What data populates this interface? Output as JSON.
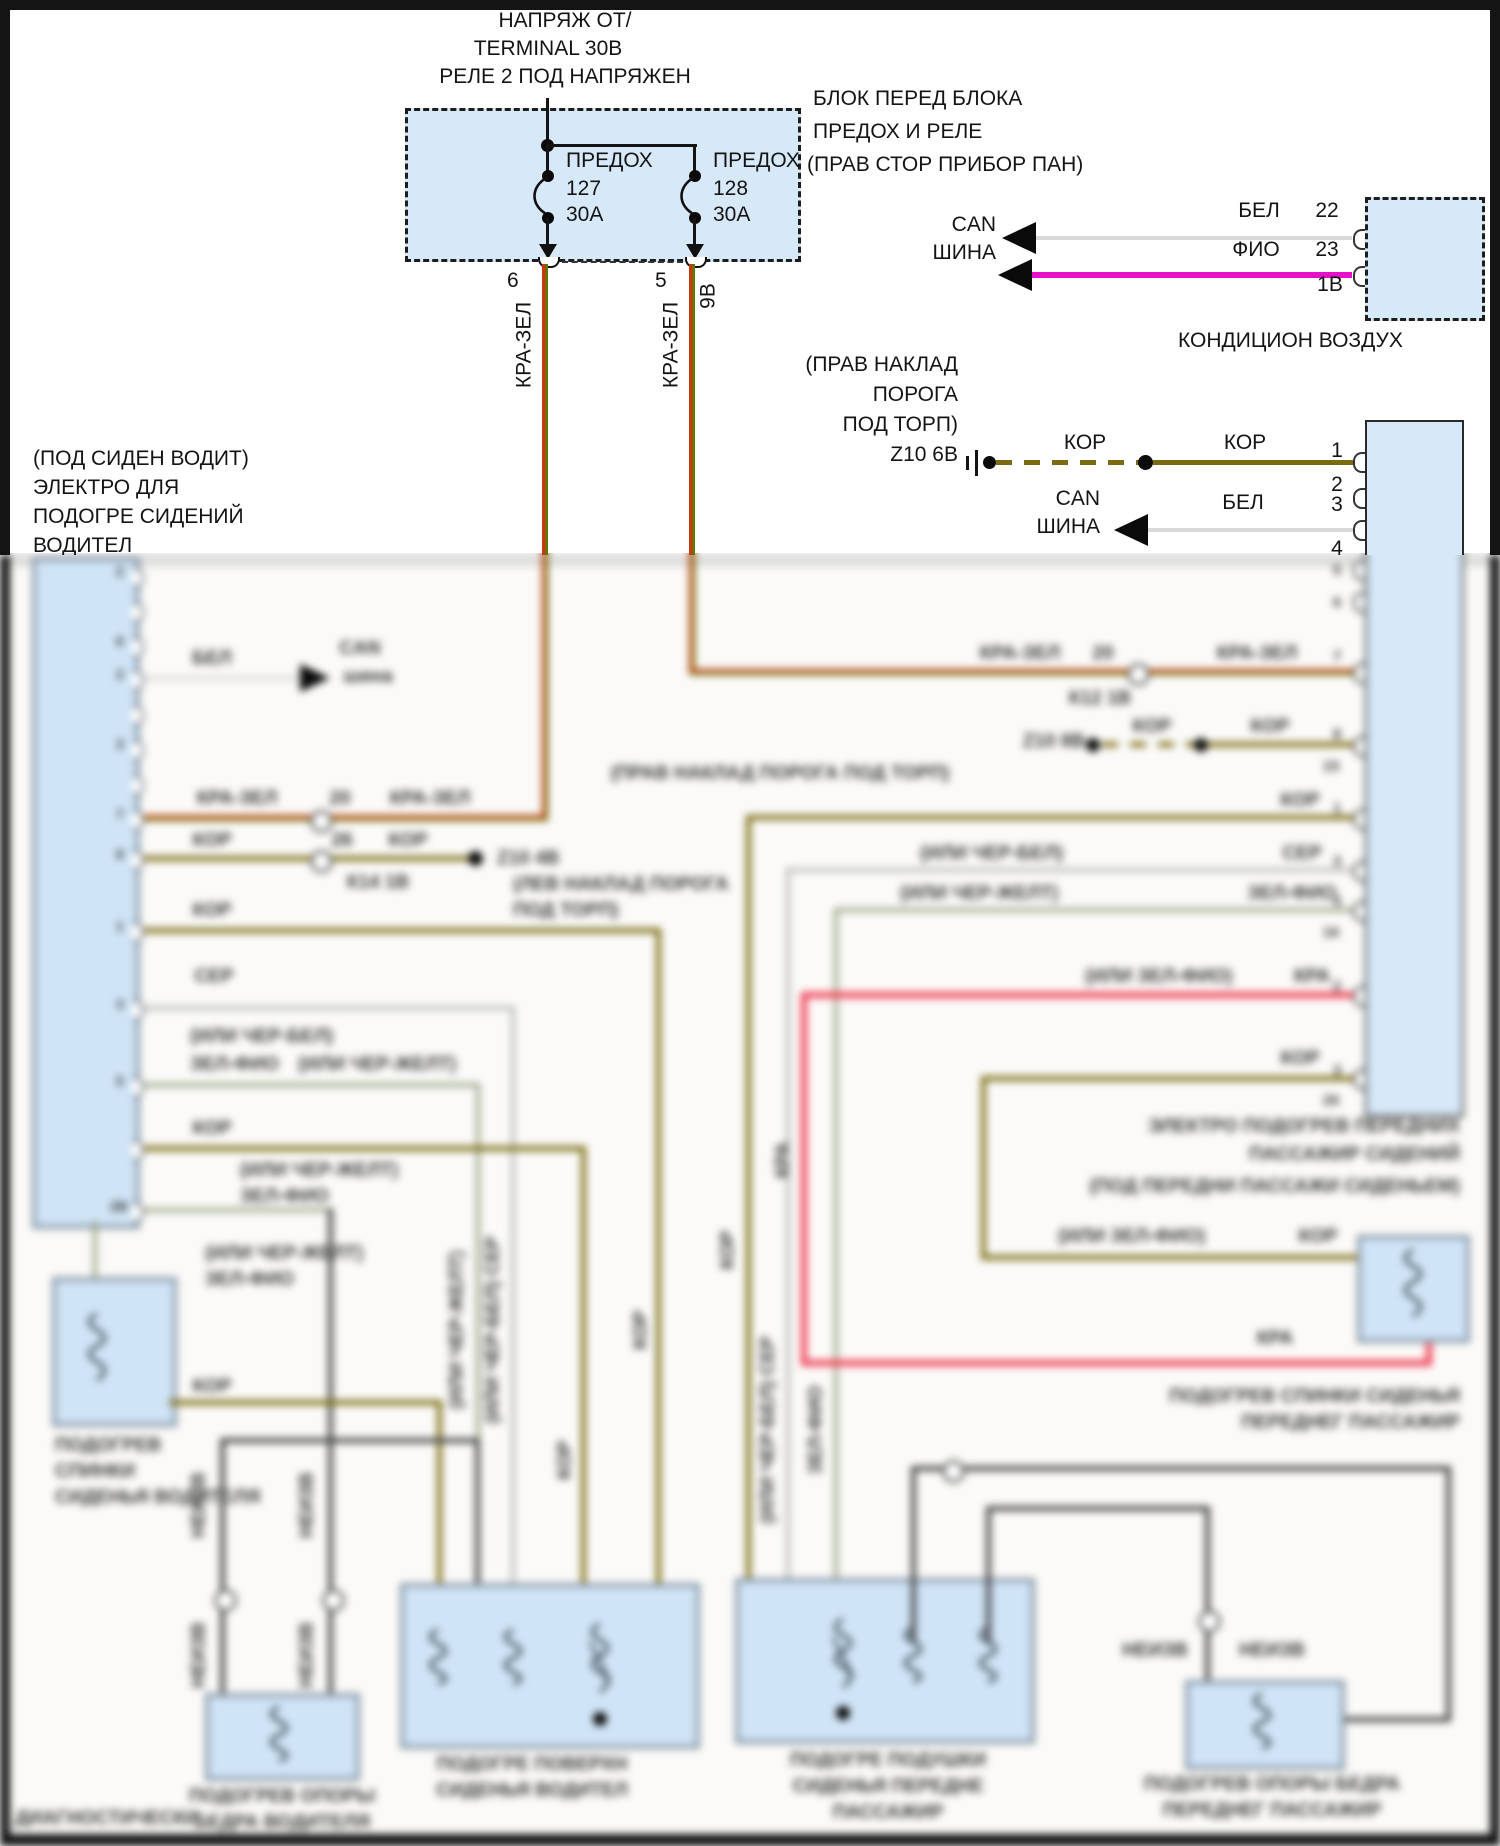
{
  "colors": {
    "box_fill": "#d7e8f8",
    "kra_zel_red": "#c63a10",
    "kra_zel_green": "#5d7a00",
    "kor": "#7a6a10",
    "fio": "#e611c9",
    "bel": "#d8d8d8",
    "ser": "#b9b9b9",
    "zel_fio": "#97a183",
    "kra": "#ef4055",
    "cher": "#474747"
  },
  "top": {
    "feed": [
      "НАПРЯЖ ОТ/",
      "TERMINAL 30В",
      "РЕЛЕ 2 ПОД НАПРЯЖЕН"
    ],
    "block_label": [
      "БЛОК ПЕРЕД БЛОКА",
      "ПРЕДОХ И РЕЛЕ",
      "(ПРАВ СТОР ПРИБОР ПАН)"
    ],
    "fuse1": {
      "t": "ПРЕДОХ",
      "n": "127",
      "a": "30А"
    },
    "fuse2": {
      "t": "ПРЕДОХ",
      "n": "128",
      "a": "30А"
    },
    "pin_left": "6",
    "pin_right": "5",
    "pin_right2": "9В",
    "wire": "КРА-ЗЕЛ"
  },
  "ac": {
    "can": "CAN",
    "bus": "ШИНА",
    "w1": "БЕЛ",
    "p1": "22",
    "w2": "ФИО",
    "p2": "23",
    "p3": "1В",
    "name": "КОНДИЦИОН ВОЗДУХ"
  },
  "sill_right": {
    "l1": "(ПРАВ НАКЛАД",
    "l2": "ПОРОГА",
    "l3": "ПОД ТОРП)",
    "gnd": "Z10 6В",
    "w1": "КОР",
    "w2": "КОР",
    "p1": "1",
    "p2": "2"
  },
  "canr": {
    "can": "CAN",
    "bus": "ШИНА",
    "w": "БЕЛ",
    "p3": "3",
    "p4": "4"
  },
  "driver_module": [
    "(ПОД СИДЕН ВОДИТ)",
    "ЭЛЕКТРО ДЛЯ",
    "ПОДОГРЕ СИДЕНИЙ",
    "ВОДИТЕЛ"
  ],
  "lm": {
    "bel": "БЕЛ",
    "can": "CAN",
    "bus": "шина",
    "kz1": "КРА-ЗЕЛ",
    "kz_pin": "20",
    "kz2": "КРА-ЗЕЛ",
    "kor1": "КОР",
    "kor_pin": "26",
    "kor2": "КОР",
    "conn": "К14 1В",
    "gnd": "Z10 4В",
    "sill1": "(ЛЕВ НАКЛАД ПОРОГА",
    "sill2": "ПОД ТОРП)",
    "kor3": "КОР",
    "ser": "СЕР",
    "alt_bel": "(ИЛИ ЧЕР-БЕЛ)",
    "zf1": "ЗЕЛ-ФИО",
    "alt_zh1": "(ИЛИ ЧЕР-ЖЕЛТ)",
    "kor4": "КОР",
    "alt_zh2": "(ИЛИ ЧЕР-ЖЕЛТ)",
    "zf2": "ЗЕЛ-ФИО",
    "alt_zh3": "(ИЛИ ЧЕР-ЖЕЛТ)",
    "zf3": "ЗЕЛ-ФИО",
    "kor5": "КОР",
    "rot_kor1": "КОР",
    "rot_serbel": "(ИЛИ ЧЕР-БЕЛ) СЕР",
    "rot_zh": "(ИЛИ ЧЕР-ЖЕЛТ)",
    "rot_kor2": "КОР",
    "pins": [
      "2",
      "4",
      "6",
      "2",
      "8",
      "3",
      "16",
      "7",
      "8",
      "1",
      "3",
      "4",
      "5",
      "1",
      "2В",
      "28"
    ]
  },
  "rm": {
    "kz1": "КРА-ЗЕЛ",
    "kz_pin": "20",
    "kz_conn": "К12 1В",
    "kz2": "КРА-ЗЕЛ",
    "gnd8": "Z10 8В",
    "kord1": "КОР",
    "kord2": "КОР",
    "sill": "(ПРАВ НАКЛАД ПОРОГА ПОД ТОРП)",
    "kor1": "КОР",
    "serbel": "(ИЛИ ЧЕР-БЕЛ)",
    "ser": "СЕР",
    "zh": "(ИЛИ ЧЕР-ЖЕЛТ)",
    "zf": "ЗЕЛ-ФИО",
    "zfk": "(ИЛИ ЗЕЛ-ФИО)",
    "kra": "КРА",
    "kor2": "КОР",
    "zfk2": "(ИЛИ ЗЕЛ-ФИО)",
    "kor3": "КОР",
    "kra2": "КРА",
    "rot_kor": "КОР",
    "rot_ser": "(ИЛИ ЧЕР-БЕЛ) СЕР",
    "rot_zf": "ЗЕЛ-ФИО",
    "rot_kra": "КРА",
    "pins": [
      "5",
      "6",
      "7",
      "1В",
      "8",
      "15",
      "1",
      "3",
      "4",
      "16",
      "2",
      "3",
      "26"
    ],
    "title": [
      "ЭЛЕКТРО ПОДОГРЕВ ПЕРЕДНИХ",
      "ПАССАЖИР СИДЕНИЙ",
      "(ПОД ПЕРЕДНИ ПАССАЖИ СИДЕНЬЕМ)"
    ]
  },
  "comp": {
    "backrest_driver": [
      "ПОДОГРЕВ",
      "СПИНКИ",
      "СИДЕНЬЯ ВОДИТЕЛЯ"
    ],
    "surface_driver": [
      "ПОДОГРЕ ПОВЕРХН",
      "СИДЕНЬЯ ВОДИТЕЛ"
    ],
    "cushion_pass": [
      "ПОДОГРЕ ПОДУШКИ",
      "СИДЕНЬЯ ПЕРЕДНЕ",
      "ПАССАЖИР"
    ],
    "thigh_driver": [
      "ПОДОГРЕВ ОПОРЫ",
      "БЕДРА ВОДИТЕЛЯ"
    ],
    "thigh_pass": [
      "ПОДОГРЕВ ОПОРЫ БЕДРА",
      "ПЕРЕДНЕГ ПАССАЖИР"
    ],
    "backrest_pass": [
      "ПОДОГРЕВ СПИНКИ СИДЕНЬЯ",
      "ПЕРЕДНЕГ ПАССАЖИР"
    ],
    "diag": "ДИАГНОСТИЧЕСКИ",
    "unk1": "НЕИЗВ",
    "unk2": "НЕИЗВ",
    "unk3": "НЕИЗВ",
    "unk4": "НЕИЗВ",
    "unk5": "НЕИЗВ",
    "unk6": "НЕИЗВ"
  }
}
